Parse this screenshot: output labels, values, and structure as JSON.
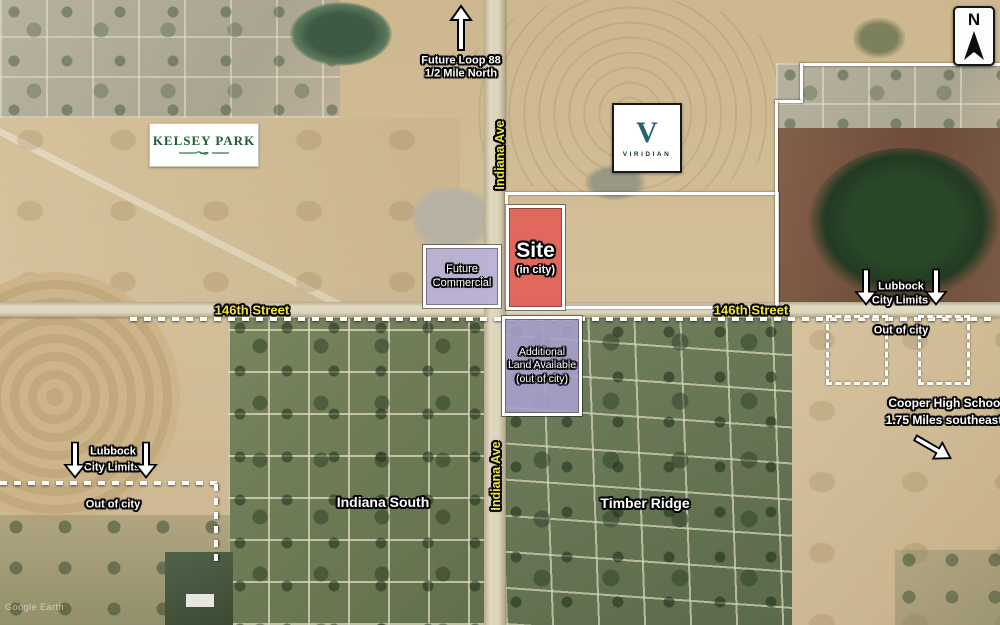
{
  "attribution": "Google Earth",
  "north_arrow_label": "N",
  "roads": {
    "indiana_ave": "Indiana Ave",
    "street_146": "146th Street"
  },
  "neighborhoods": {
    "kelsey_park": "KELSEY PARK",
    "indiana_south": "Indiana South",
    "timber_ridge": "Timber Ridge"
  },
  "viridian": {
    "initial": "V",
    "name": "VIRIDIAN"
  },
  "site": {
    "title": "Site",
    "subtitle": "(in city)",
    "fill": "#e25c54"
  },
  "future_commercial": {
    "line1": "Future",
    "line2": "Commercial",
    "fill": "#b7b1d9"
  },
  "additional_land": {
    "line1": "Additional",
    "line2": "Land Available",
    "line3": "(out of city)",
    "fill": "#a99fcb"
  },
  "future_loop": {
    "line1": "Future Loop 88",
    "line2": "1/2 Mile North"
  },
  "city_limits": {
    "line1": "Lubbock",
    "line2": "City Limits",
    "out_of_city": "Out of city"
  },
  "cooper": {
    "line1": "Cooper High School",
    "line2": "1.75 Miles southeast"
  },
  "label_colors": {
    "road_yellow": "#f2e43c",
    "kelsey_green": "#1d5c35",
    "viridian_teal": "#2a6273"
  }
}
